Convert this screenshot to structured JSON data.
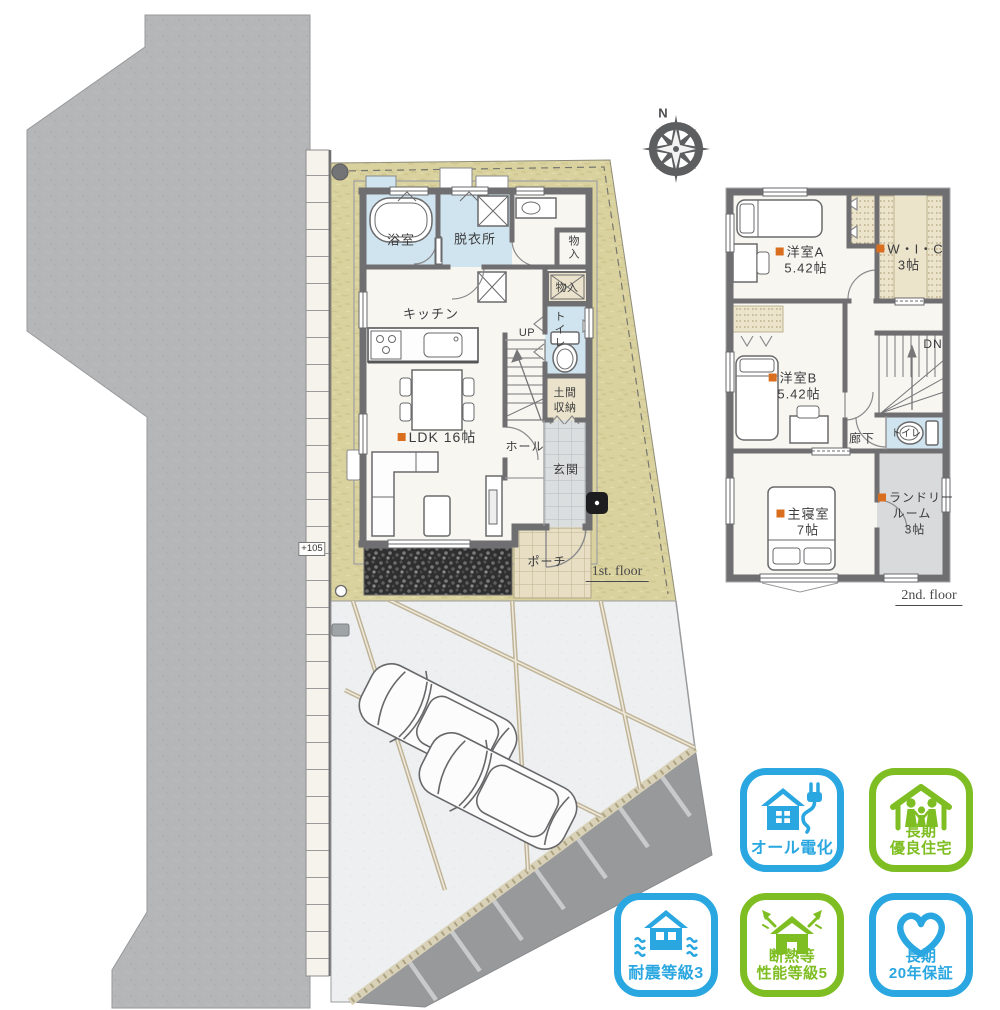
{
  "site": {
    "elevation_marker": "+105",
    "compass_north": "N"
  },
  "floor1": {
    "bath": "浴室",
    "dressing": "脱衣所",
    "kitchen": "キッチン",
    "ldk": "LDK 16帖",
    "up": "UP",
    "closet_a": "物入",
    "closet_b": "物入",
    "toilet": "トイレ",
    "doma_line1": "土間",
    "doma_line2": "収納",
    "hall": "ホール",
    "entrance": "玄関",
    "porch": "ポーチ",
    "floor_label": "1st. floor"
  },
  "floor2": {
    "room_a": "洋室A",
    "room_a_size": "5.42帖",
    "wic": "W・I・C",
    "wic_size": "3帖",
    "room_b": "洋室B",
    "room_b_size": "5.42帖",
    "corridor": "廊下",
    "down": "DN",
    "toilet": "トイレ",
    "master": "主寝室",
    "master_size": "7帖",
    "laundry_line1": "ランドリー",
    "laundry_line2": "ルーム",
    "laundry_line3": "3帖",
    "floor_label": "2nd. floor"
  },
  "badges": [
    {
      "icon": "house-plug-icon",
      "lines": [
        "オール電化"
      ],
      "color": "#2aa7e0"
    },
    {
      "icon": "house-family-icon",
      "lines": [
        "長期",
        "優良住宅"
      ],
      "color": "#7fbe23"
    },
    {
      "icon": "house-quake-icon",
      "lines": [
        "耐震等級3"
      ],
      "color": "#2aa7e0"
    },
    {
      "icon": "house-insulation-icon",
      "lines": [
        "断熱等",
        "性能等級5"
      ],
      "color": "#7fbe23"
    },
    {
      "icon": "heart-icon",
      "lines": [
        "長期",
        "20年保証"
      ],
      "color": "#2aa7e0"
    }
  ],
  "colors": {
    "badge_blue": "#2aa7e0",
    "badge_green": "#7fbe23",
    "bullet_orange": "#d96f1e",
    "lot_tan": "#d9d19e",
    "wet_room_blue": "#cfe4ee",
    "wall_gray": "#6f6e70"
  }
}
